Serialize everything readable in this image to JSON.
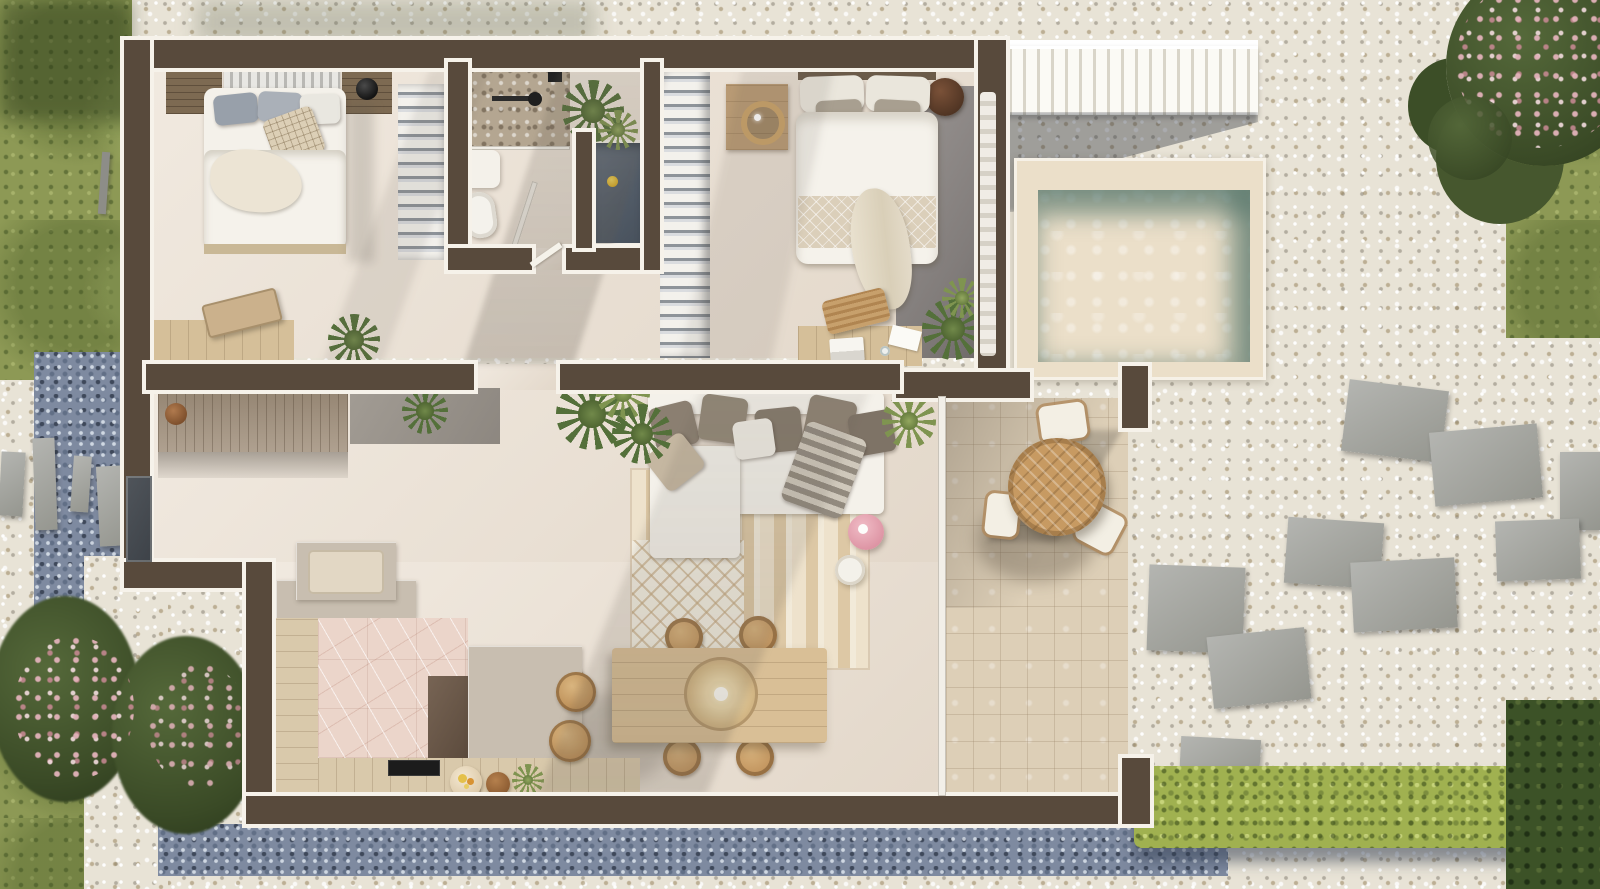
{
  "scene": {
    "title": "Aerial top-down 3D floor plan render",
    "description": "Photorealistic bird's-eye render of a single-storey holiday home with plunge pool, stone patio, gravel garden and lawn",
    "view": "top-down",
    "has_text": false
  },
  "palette": {
    "gravel": "#e8e3d6",
    "gravelBlue": "#7e8aa0",
    "grass": "#8d9955",
    "hedgeGreen": "#a0b150",
    "wall": "#584a3c",
    "wallLine": "#f6f2ea",
    "floor": "#ece2d5",
    "patio": "#ddcfb7",
    "poolDeck": "#ebdfc9",
    "poolDeep": "#8aa89e",
    "poolLight": "#c3d8cd",
    "wood": "#d5bf99",
    "woodWarm": "#c79a62",
    "woodDark": "#7d6a52",
    "greige": "#c8beb0",
    "marble": "#ebd5ca",
    "white": "#f4f1ea",
    "taupe": "#8c8073",
    "slateTub": "#5c6673",
    "concrete": "#908b89",
    "pink": "#e7a6b3",
    "duckYellow": "#e0bc3c",
    "plant": "#54703a",
    "plantDark": "#3c5227",
    "flower": "#d4a0ab"
  },
  "rooms": {
    "bedroom_1": {
      "name": "bedroom-1",
      "furniture": [
        "double-bed",
        "nightstand-left",
        "nightstand-right",
        "black-table-lamp",
        "striped-headboard",
        "wardrobe-rail",
        "desk",
        "wooden-bench",
        "grass-plant"
      ]
    },
    "bathroom": {
      "name": "bathroom",
      "furniture": [
        "pebble-shower-floor",
        "shower-fixture",
        "vanity-sink",
        "toilet",
        "glass-screen",
        "sunken-tub",
        "rubber-duck",
        "hanging-plant"
      ]
    },
    "bedroom_2": {
      "name": "bedroom-2",
      "furniture": [
        "double-bed",
        "quilted-runner",
        "throw-blanket",
        "nightstand",
        "rattan-pendant-lamp",
        "round-side-table",
        "wardrobe-rail",
        "desk",
        "desk-chair",
        "laptop",
        "papers",
        "fern-plant",
        "sheer-curtain",
        "concrete-accent-floor"
      ]
    },
    "hallway": {
      "name": "entry-hall",
      "furniture": [
        "console-sideboard",
        "vase",
        "aloe-plant",
        "entry-door"
      ]
    },
    "living_room": {
      "name": "living-room",
      "furniture": [
        "l-shaped-sofa",
        "taupe-cushions-x5",
        "white-cushion",
        "beige-cushion",
        "striped-throw",
        "striped-rug",
        "diamond-rug-panel",
        "pink-pouf",
        "round-side-table",
        "monstera-plant",
        "palm-plant"
      ]
    },
    "dining_area": {
      "name": "dining-area",
      "furniture": [
        "wooden-dining-table",
        "rattan-dome-pendant",
        "dining-chairs-x6"
      ]
    },
    "kitchen": {
      "name": "kitchen",
      "furniture": [
        "u-shaped-counter",
        "island-counter",
        "black-cooktop",
        "bar-stools-x2",
        "fruit-bowl",
        "wooden-bowl",
        "herb-plant",
        "bench-seat",
        "pink-marble-floor",
        "dark-cabinet"
      ]
    }
  },
  "outdoor": {
    "features": [
      "white-staircase",
      "plunge-pool",
      "pool-deck",
      "stone-paver-patio",
      "round-patio-table",
      "patio-chairs-x3",
      "white-gravel-garden",
      "blue-slate-gravel",
      "stepping-stones",
      "concrete-pavers",
      "flowering-shrub",
      "dark-shrubs",
      "lime-hedge",
      "lawn-strips",
      "entry-stepping-slabs"
    ]
  }
}
